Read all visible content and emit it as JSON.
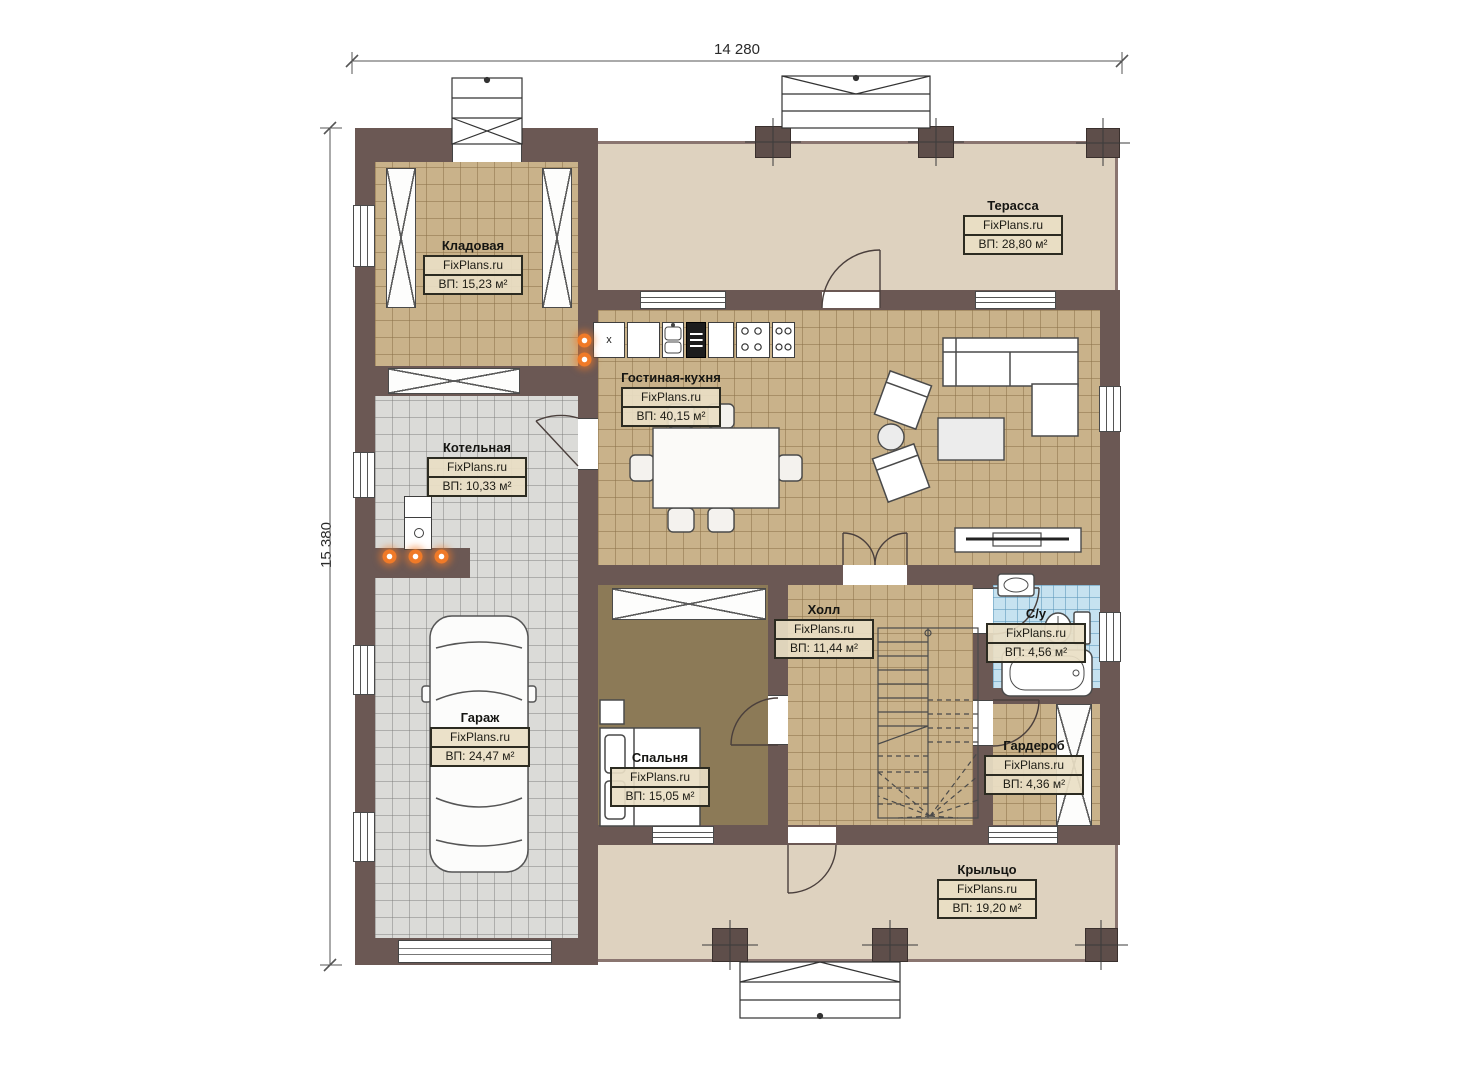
{
  "dimensions": {
    "top": "14 280",
    "left": "15 380"
  },
  "watermark": "FixPlans.ru",
  "rooms": {
    "kladovaya": {
      "name": "Кладовая",
      "area": "ВП: 15,23 м²"
    },
    "terrassa": {
      "name": "Терасса",
      "area": "ВП: 28,80 м²"
    },
    "gostinaya_kuhnya": {
      "name": "Гостиная-кухня",
      "area": "ВП: 40,15 м²"
    },
    "kotelnaya": {
      "name": "Котельная",
      "area": "ВП: 10,33 м²"
    },
    "garazh": {
      "name": "Гараж",
      "area": "ВП: 24,47 м²"
    },
    "spalnya": {
      "name": "Спальня",
      "area": "ВП: 15,05 м²"
    },
    "kholl": {
      "name": "Холл",
      "area": "ВП: 11,44 м²"
    },
    "sanuzel": {
      "name": "С/у",
      "area": "ВП: 4,56 м²"
    },
    "garderob": {
      "name": "Гардероб",
      "area": "ВП: 4,36 м²"
    },
    "kryltso": {
      "name": "Крыльцо",
      "area": "ВП: 19,20 м²"
    }
  },
  "kitchen": {
    "washer_mark": "x"
  },
  "colors": {
    "wall": "#6b5854",
    "floor_tan": "#c9b28a",
    "floor_gray": "#dbdbd8",
    "floor_brown": "#8c7a57",
    "floor_blue": "#c6e2f0",
    "floor_beige": "#ded2bf",
    "heating_orange": "#f07a28"
  }
}
